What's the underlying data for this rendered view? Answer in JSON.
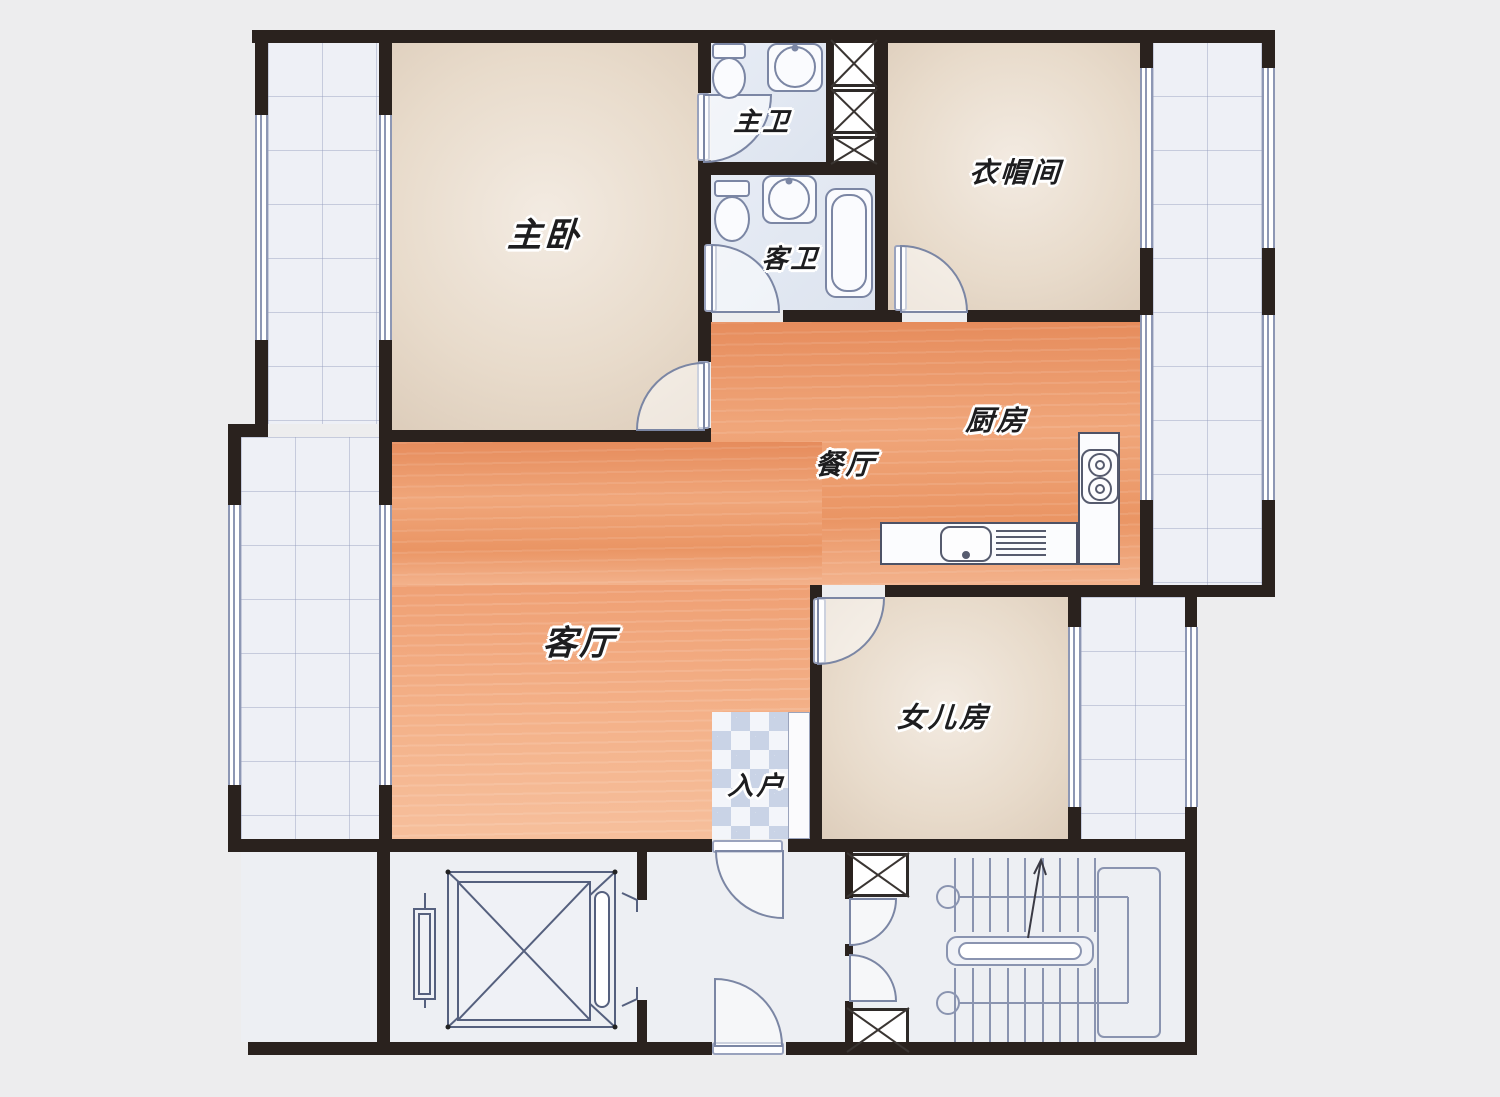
{
  "rooms": {
    "master_bedroom": {
      "label": "主卧"
    },
    "master_bath": {
      "label": "主卫"
    },
    "guest_bath": {
      "label": "客卫"
    },
    "cloakroom": {
      "label": "衣帽间"
    },
    "kitchen": {
      "label": "厨房"
    },
    "dining_room": {
      "label": "餐厅"
    },
    "living_room": {
      "label": "客厅"
    },
    "daughter_room": {
      "label": "女儿房"
    },
    "entry": {
      "label": "入户"
    }
  },
  "colors": {
    "wall": "#2a221e",
    "wood_floor": "#ec9a6c",
    "bedroom_floor": "#e8dccf",
    "tile_floor": "#eef0f6",
    "bath_floor": "#e2e8f2",
    "corridor_floor": "#edeff3",
    "fixture_line": "#7b86a4",
    "background": "#ededee"
  }
}
